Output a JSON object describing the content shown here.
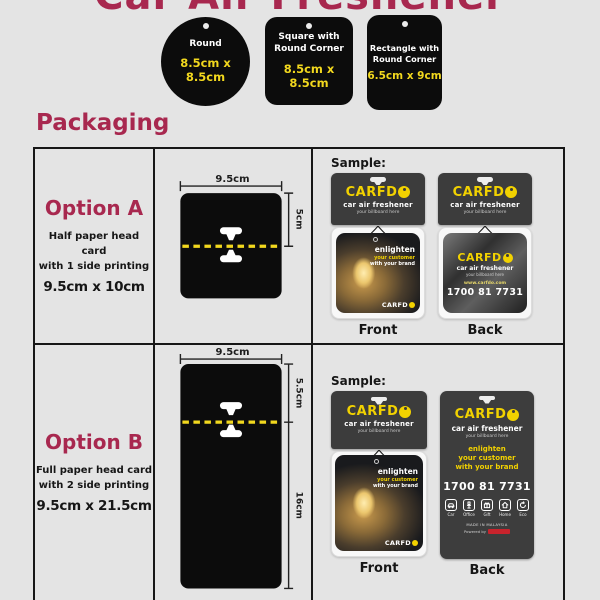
{
  "page": {
    "title": "Car Air Freshener",
    "packaging_heading": "Packaging"
  },
  "shapes": [
    {
      "line1": "Round",
      "size": "8.5cm x 8.5cm"
    },
    {
      "line1": "Square with",
      "line2": "Round Corner",
      "size": "8.5cm x 8.5cm"
    },
    {
      "line1": "Rectangle with",
      "line2": "Round Corner",
      "size": "6.5cm x 9cm"
    }
  ],
  "options": [
    {
      "name": "Option A",
      "desc1": "Half paper head card",
      "desc2": "with 1 side printing",
      "size": "9.5cm x 10cm",
      "dims": {
        "width": "9.5cm",
        "top": "5cm"
      },
      "sample_label": "Sample:",
      "front_label": "Front",
      "back_label": "Back"
    },
    {
      "name": "Option B",
      "desc1": "Full paper head card",
      "desc2": "with 2 side printing",
      "size": "9.5cm x 21.5cm",
      "dims": {
        "width": "9.5cm",
        "top": "5.5cm",
        "bottom": "16cm"
      },
      "sample_label": "Sample:",
      "front_label": "Front",
      "back_label": "Back"
    }
  ],
  "brand": {
    "logo": "CARFDO",
    "logo_prefix": "CARFD",
    "tagline": "car air freshener",
    "subtagline": "your billboard here",
    "slogan1": "enlighten",
    "slogan2": "your customer",
    "slogan3": "with your brand",
    "website": "www.carfdo.com",
    "phone": "1700 81 7731",
    "made_in": "MADE IN MALAYSIA",
    "powered_by": "Powered by",
    "icon_labels": [
      "Car",
      "Office",
      "Gift",
      "Home",
      "Eco"
    ]
  },
  "colors": {
    "accent_magenta": "#a8284f",
    "brand_yellow": "#f2d200",
    "tag_black": "#0c0c0c",
    "dash_yellow": "#f2d81e"
  }
}
